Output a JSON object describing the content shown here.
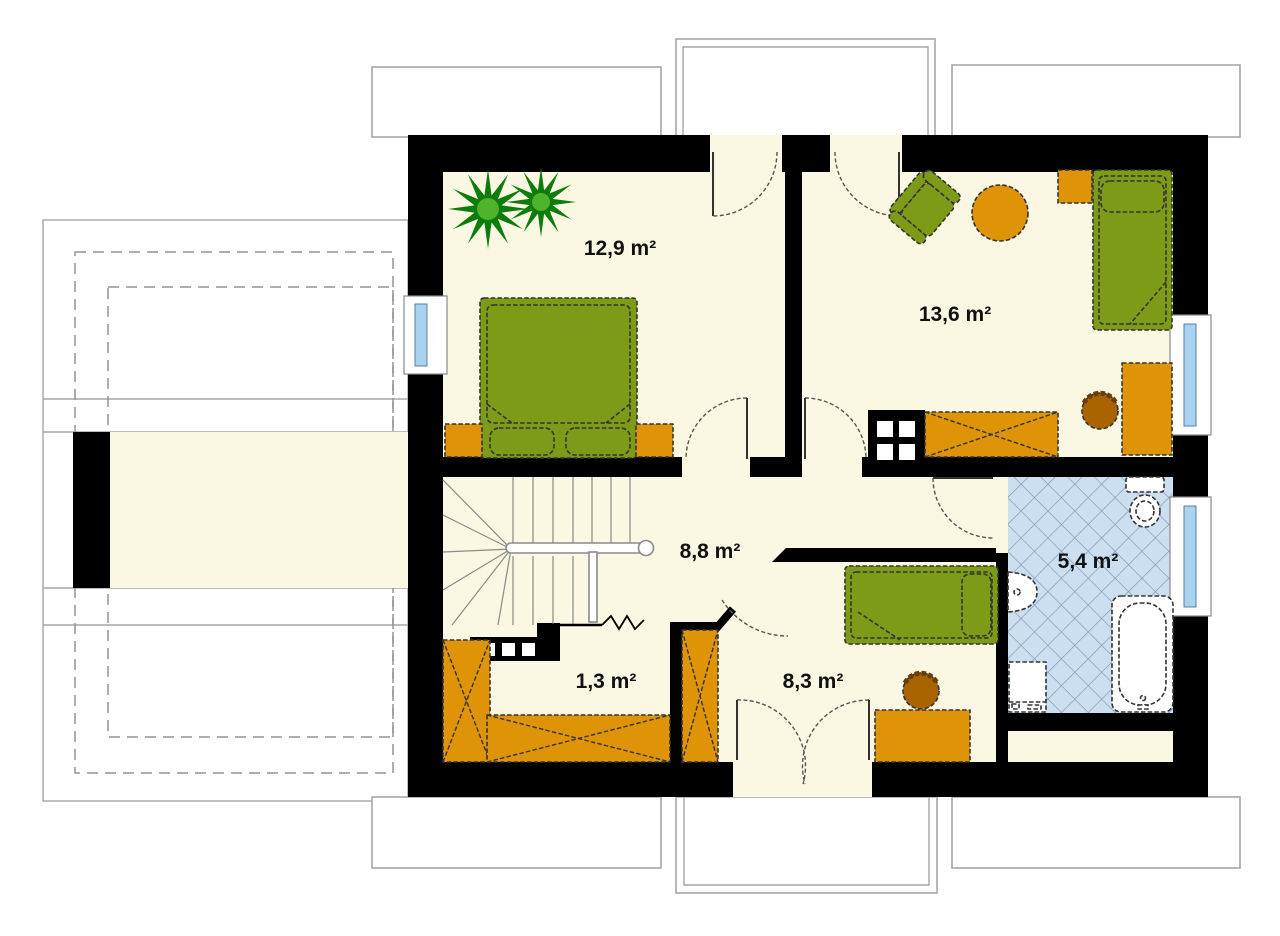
{
  "plan": {
    "rooms": [
      {
        "name": "bedroom-top-left",
        "area": "12,9 m²"
      },
      {
        "name": "bedroom-top-right",
        "area": "13,6 m²"
      },
      {
        "name": "hall",
        "area": "8,8 m²"
      },
      {
        "name": "bathroom",
        "area": "5,4 m²"
      },
      {
        "name": "closet",
        "area": "1,3 m²"
      },
      {
        "name": "bedroom-bottom",
        "area": "8,3 m²"
      }
    ],
    "colors": {
      "wall": "#000000",
      "floor": "#FAF7E2",
      "furniture_green": "#7D9B17",
      "furniture_orange": "#DF9306",
      "chair_brown": "#A96400",
      "plant_dark": "#0C7D0C",
      "plant_light": "#4FB32B",
      "tile_fill": "#CBDFF1",
      "tile_line": "#8095B0",
      "window_glass": "#A8D2F0",
      "outline_gray": "#A6A6A6",
      "label_text": "#111111"
    },
    "furniture": {
      "bedroom_top_left": [
        "plant",
        "double-bed",
        "nightstand",
        "nightstand"
      ],
      "bedroom_top_right": [
        "armchair",
        "round-table",
        "nightstand",
        "single-bed",
        "chimney",
        "wardrobe",
        "desk",
        "chair"
      ],
      "hall": [
        "staircase"
      ],
      "bathroom": [
        "toilet",
        "sink",
        "washing-machine",
        "bathtub"
      ],
      "closet": [
        "wardrobe",
        "wardrobe"
      ],
      "bedroom_bottom": [
        "wardrobe",
        "single-bed",
        "desk",
        "chair"
      ]
    }
  }
}
